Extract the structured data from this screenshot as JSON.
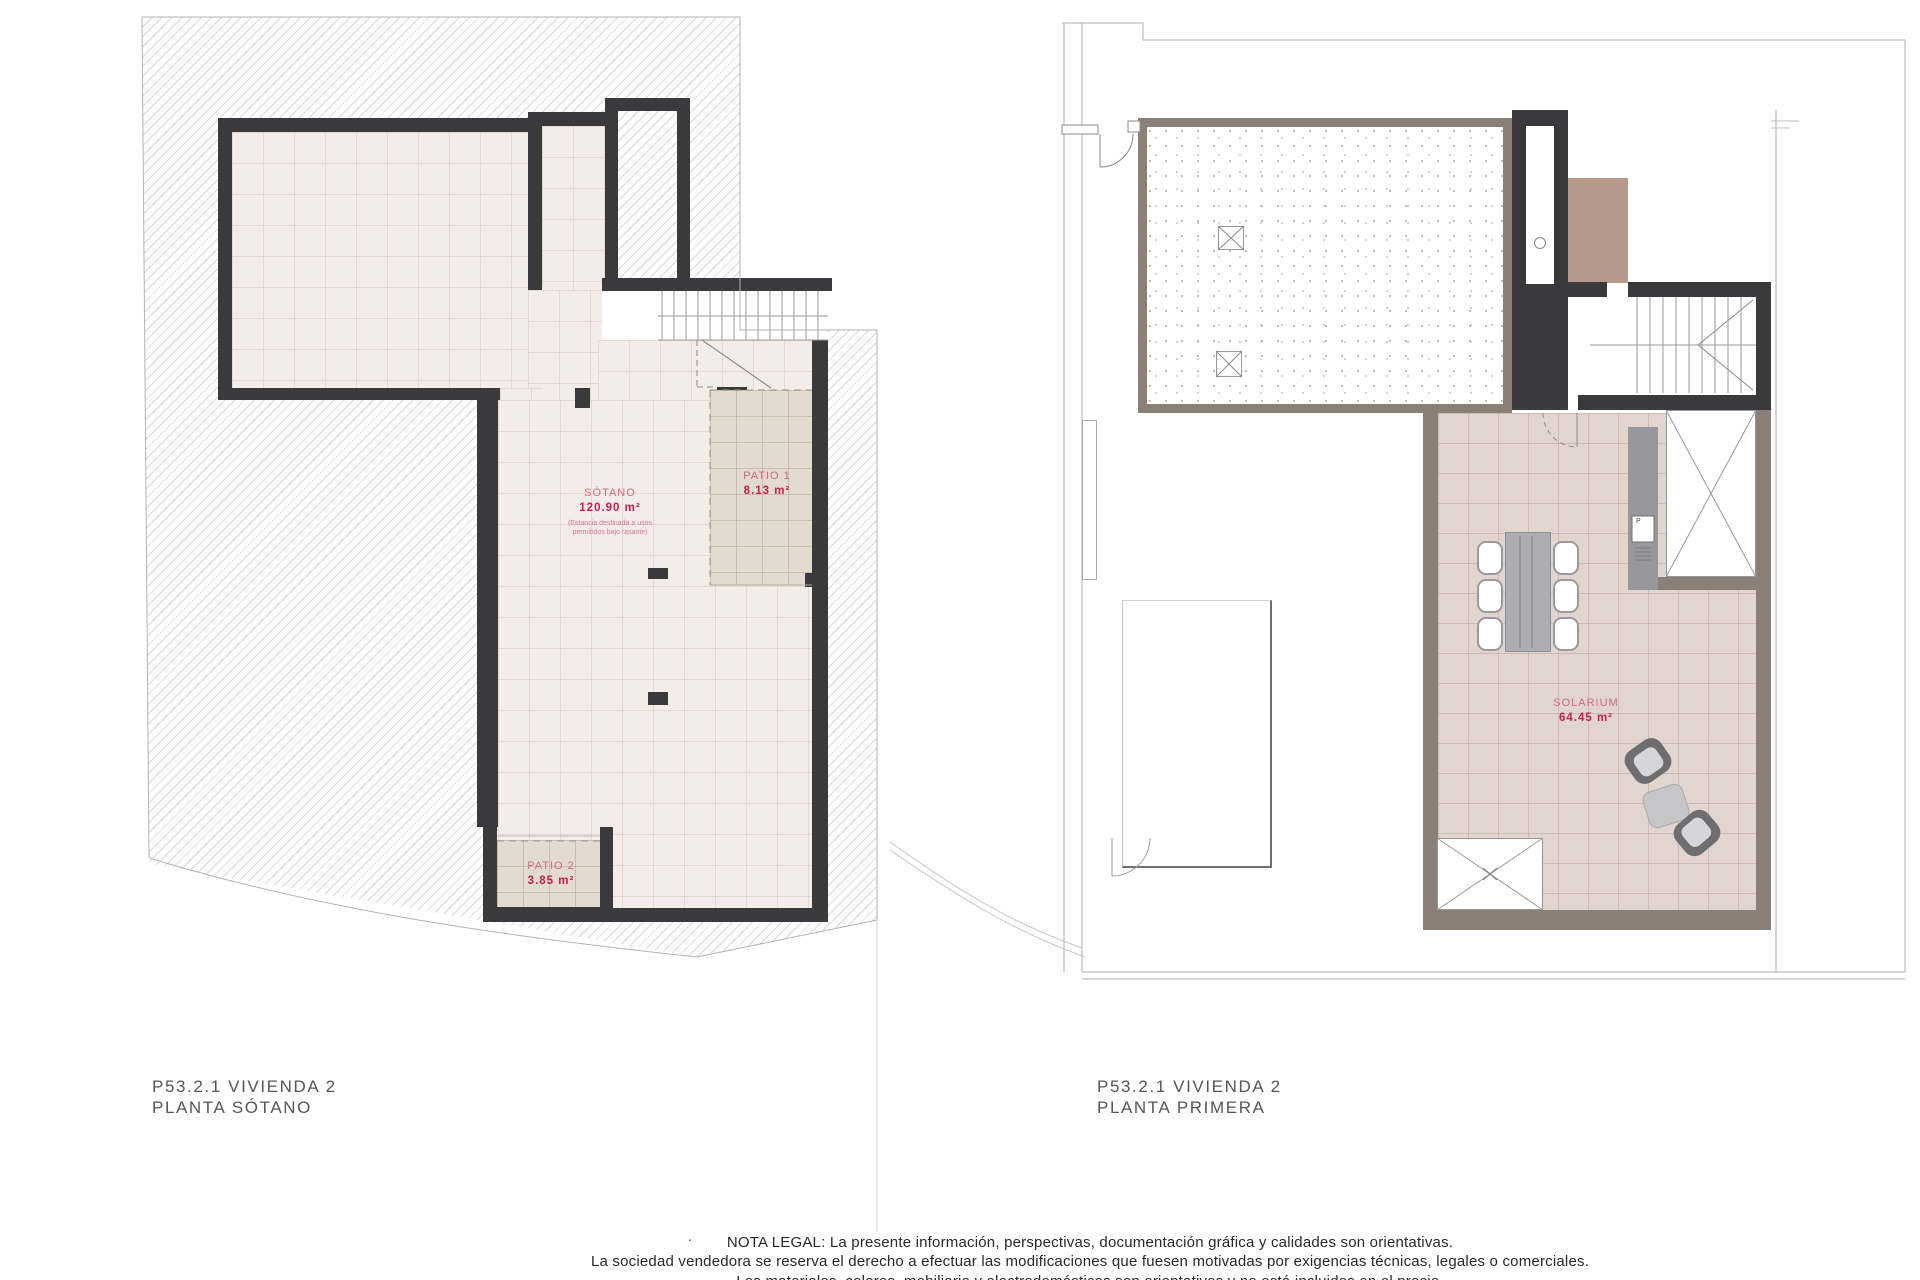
{
  "left_plan": {
    "title_line1": "P53.2.1 VIVIENDA 2",
    "title_line2": "PLANTA SÓTANO",
    "rooms": {
      "sotano": {
        "name": "SÓTANO",
        "area": "120.90 m²",
        "note_line1": "(Estancia destinada a usos",
        "note_line2": "permitidos bajo rasante)"
      },
      "patio1": {
        "name": "PATIO 1",
        "area": "8.13 m²"
      },
      "patio2": {
        "name": "PATIO 2",
        "area": "3.85 m²"
      }
    }
  },
  "right_plan": {
    "title_line1": "P53.2.1 VIVIENDA 2",
    "title_line2": "PLANTA PRIMERA",
    "rooms": {
      "solarium": {
        "name": "SOLARIUM",
        "area": "64.45 m²"
      }
    },
    "appliance_label": "P"
  },
  "legal": {
    "line1": "NOTA LEGAL: La presente información, perspectivas, documentación gráfica y calidades son orientativas.",
    "line2": "La sociedad vendedora se reserva el derecho a efectuar las modificaciones que fuesen motivadas por exigencias técnicas, legales o comerciales.",
    "line3": "Los materiales, colores, mobiliario y electrodomésticos son orientativos y no está incluidos en el precio."
  },
  "separator_dot": ".",
  "colors": {
    "wall_dark": "#3a3a3c",
    "wall_gray": "#8b8078",
    "floor_basement": "#f3ece8",
    "floor_solarium": "#e2d5cf",
    "patio_fill": "#e3dbd0",
    "brown_volume": "#b59a8b",
    "gray_band": "#98979c",
    "label_pink": "#cf6a7e",
    "label_red": "#c51f4e",
    "hatch_line": "#d8d8d8"
  }
}
